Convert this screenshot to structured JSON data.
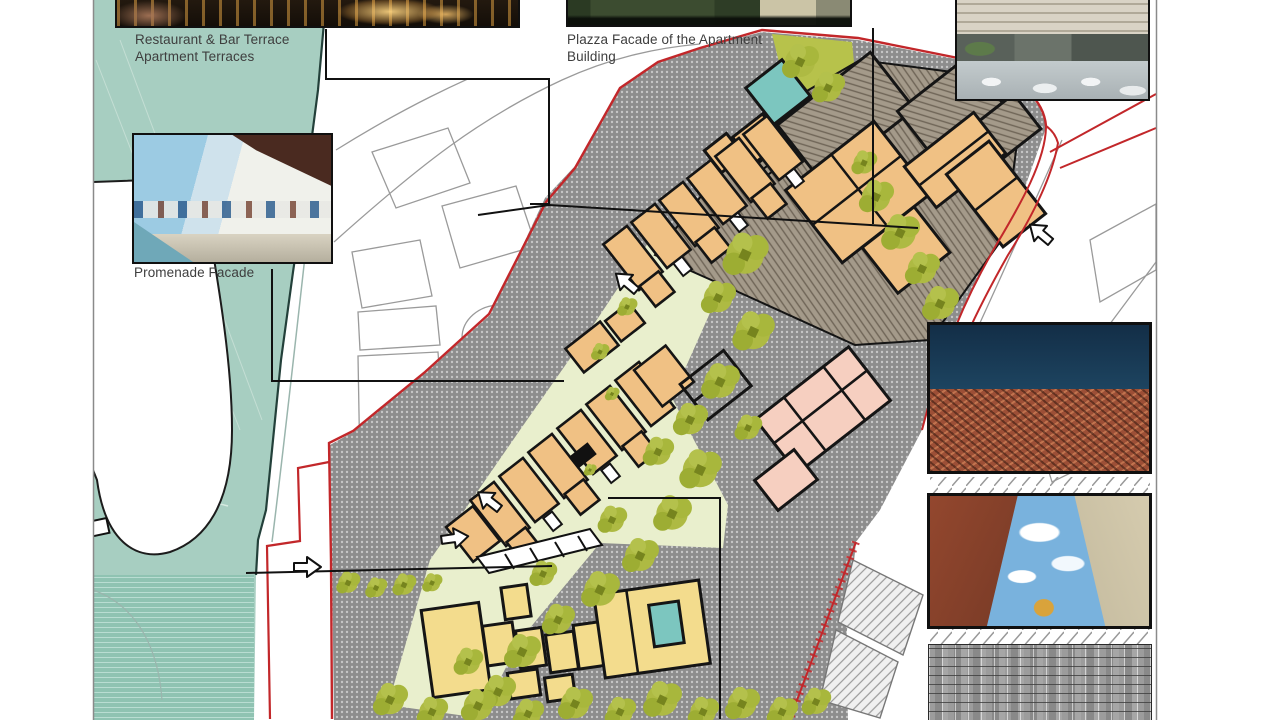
{
  "labels": {
    "restaurant": {
      "line1": "Restaurant & Bar Terrace",
      "line2": "Apartment Terraces"
    },
    "plazza": {
      "line1": "Plazza Facade of the Apartment",
      "line2": "Building"
    },
    "promenade": {
      "line1": "Promenade Facade"
    }
  },
  "palette": {
    "water": "#a7cec1",
    "water_deep": "#8fc3b2",
    "plaza_gray": "#8e8e8e",
    "building_tan": "#f0c184",
    "building_yellow": "#f3dc8d",
    "building_pink": "#f6cfc0",
    "roof_hatch_brown": "#a49a8a",
    "pool_teal": "#7cc6bf",
    "lawn_green": "#e9efcd",
    "tree_olive": "#aeba43",
    "site_boundary_red": "#c2272a",
    "drawing_line_black": "#141414",
    "context_line_gray": "#9a9a9a"
  },
  "photos": {
    "restaurant_terrace": "restaurant-bar-terrace-night-photo",
    "plaza_facade": "plaza-facade-photo",
    "roof_lounge": "roof-lounge-interior-photo",
    "promenade_facade": "promenade-facade-photo",
    "aerial_town": "aerial-old-town-photo",
    "street_canyon": "street-canyon-photo",
    "stone_wall": "stone-wall-texture-photo"
  }
}
